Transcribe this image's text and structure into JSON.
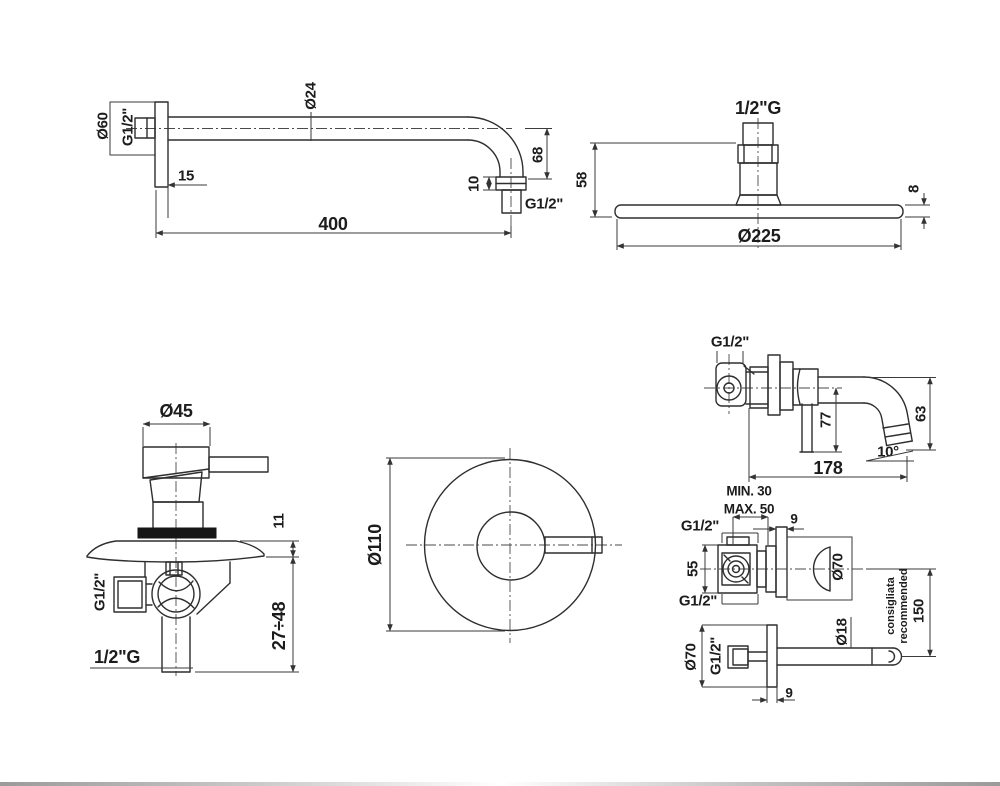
{
  "sheet": {
    "description": "Shower set technical dimension drawings",
    "background": "#ffffff",
    "line_color": "#2e2e2e",
    "text_color": "#1c1c1c"
  },
  "drawings": {
    "shower_arm": {
      "name": "wall shower arm",
      "labels": {
        "flange_diameter": "Ø60",
        "wall_thread": "G1/2\"",
        "flange_offset": "15",
        "arm_diameter": "Ø24",
        "drop_height": "68",
        "nut_height": "10",
        "end_thread": "G1/2\"",
        "arm_length": "400"
      }
    },
    "shower_head": {
      "name": "shower head",
      "labels": {
        "thread": "1/2\"G",
        "total_height": "58",
        "plate_thickness": "8",
        "head_diameter": "Ø225"
      }
    },
    "mixer_side": {
      "name": "concealed mixer side view",
      "labels": {
        "handle_diameter": "Ø45",
        "plate_offset": "11",
        "side_thread": "G1/2\"",
        "bottom_thread": "1/2\"G",
        "recess_depth": "27÷48"
      }
    },
    "mixer_front": {
      "name": "mixer plate front view",
      "labels": {
        "plate_diameter": "Ø110"
      }
    },
    "wall_spout": {
      "name": "wall spout side view",
      "labels": {
        "thread": "G1/2\"",
        "drop_center": "77",
        "drop_outlet": "63",
        "outlet_angle": "10°",
        "spout_reach": "178"
      }
    },
    "valve_side": {
      "name": "concealed valve side view",
      "labels": {
        "recess_min": "MIN. 30",
        "recess_max": "MAX. 50",
        "plate_thickness": "9",
        "top_thread": "G1/2\"",
        "body_height": "55",
        "bottom_thread": "G1/2\"",
        "plate_diameter": "Ø70"
      }
    },
    "spout_side": {
      "name": "spout wall flange side view",
      "labels": {
        "flange_diameter": "Ø70",
        "thread": "G1/2\"",
        "tube_diameter": "Ø18",
        "distance": "150",
        "note_line1": "consigliata",
        "note_line2": "recommended",
        "plate_thickness": "9"
      }
    }
  }
}
